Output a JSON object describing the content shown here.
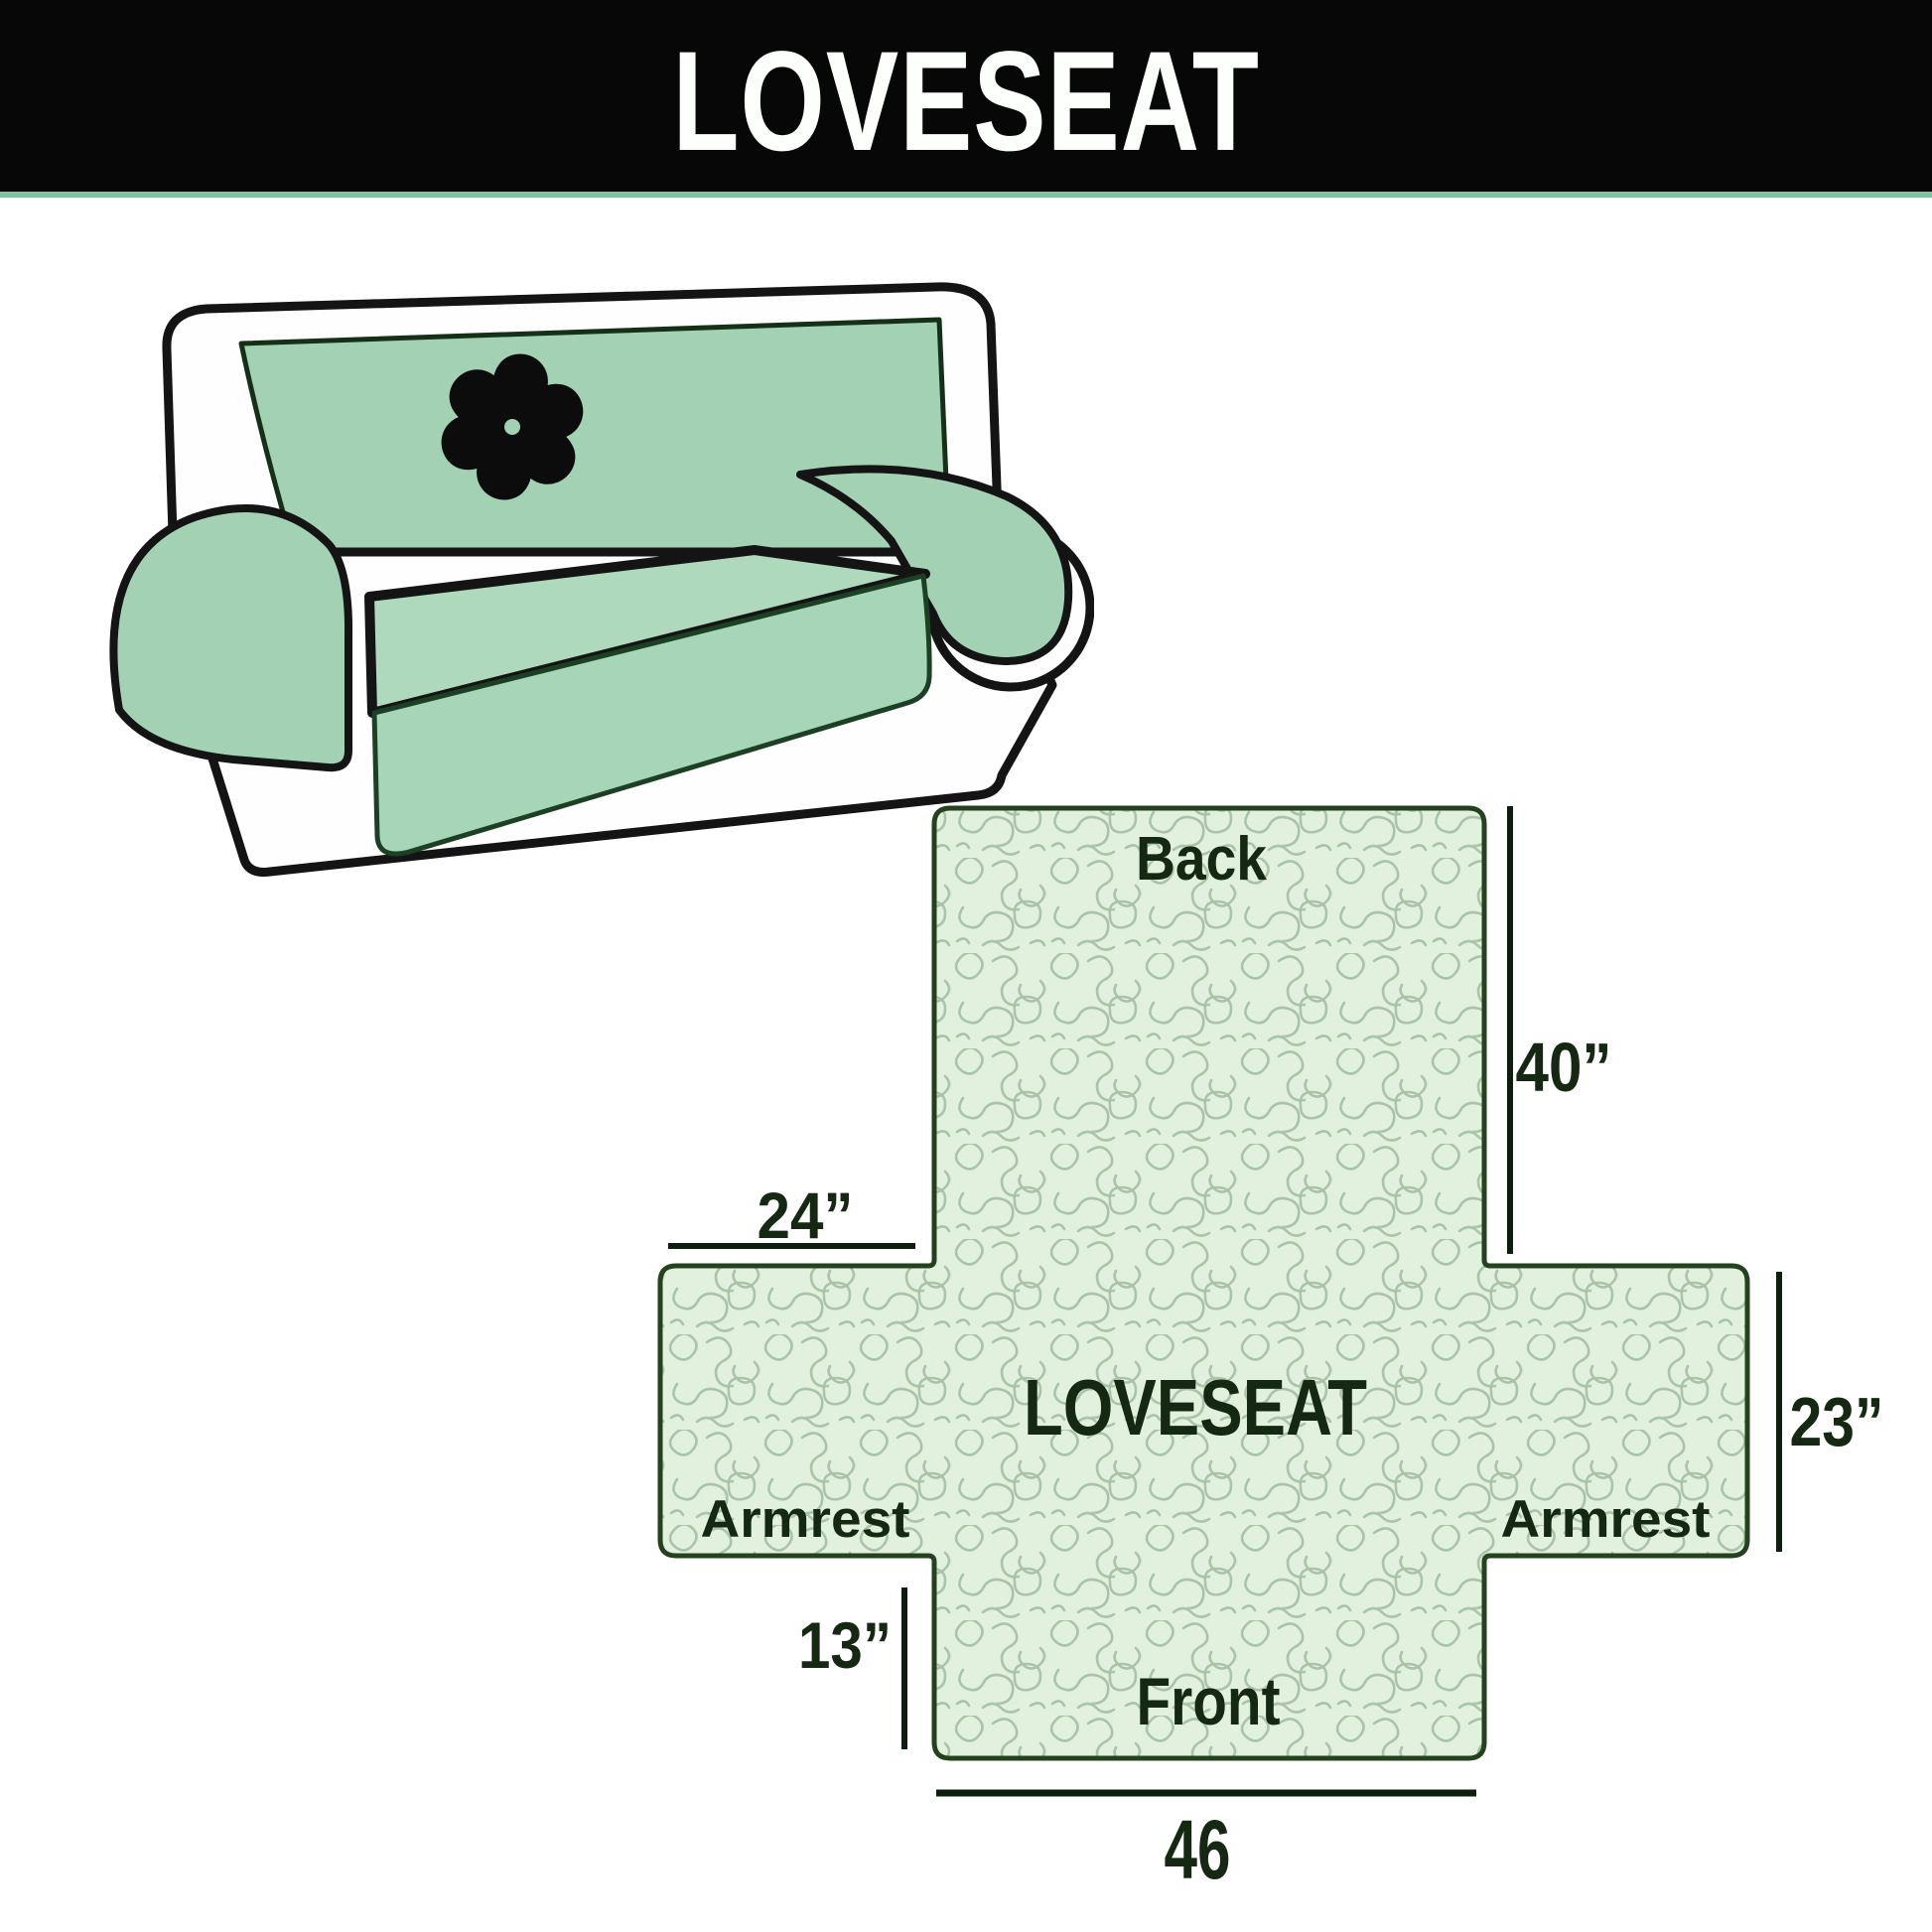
{
  "banner": {
    "title": "LOVESEAT",
    "background": "#070707",
    "text_color": "#fdfffd",
    "underline_color": "#7ec29e"
  },
  "sofa": {
    "description": "loveseat with quilted slipcover",
    "cover_color": "#a2d2b3",
    "seat_color": "#aed9bd",
    "outline_color": "#141414",
    "logo": "pinwheel"
  },
  "diagram": {
    "center_label": "LOVESEAT",
    "back_label": "Back",
    "front_label": "Front",
    "armrest_left_label": "Armrest",
    "armrest_right_label": "Armrest",
    "dim_back_height": "40”",
    "dim_armrest_width": "24”",
    "dim_side_height": "23”",
    "dim_front_height": "13”",
    "dim_front_width": "46",
    "fill_color": "#e2f1de",
    "pattern_color": "#abc3a8",
    "border_color": "#24421e",
    "label_color": "#152912",
    "dimension_line_color": "#0e1e0e"
  }
}
